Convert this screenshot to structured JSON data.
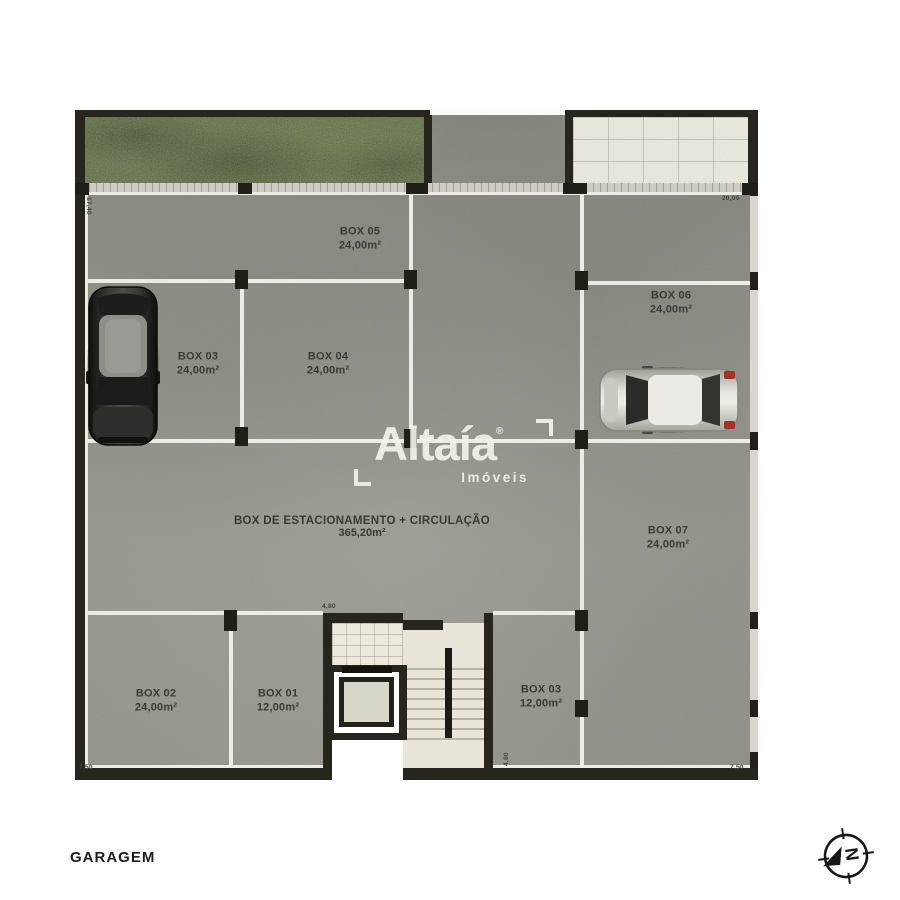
{
  "page": {
    "bottom_label": "GARAGEM"
  },
  "logo": {
    "brand": "Altaía",
    "registered": "®",
    "subtitle": "Imóveis"
  },
  "plan": {
    "central": {
      "line1": "BOX DE ESTACIONAMENTO + CIRCULAÇÃO",
      "line2": "365,20m²"
    },
    "boxes": [
      {
        "label": "BOX 05",
        "area": "24,00m²"
      },
      {
        "label": "BOX 06",
        "area": "24,00m²"
      },
      {
        "label": "BOX 03",
        "area": "24,00m²"
      },
      {
        "label": "BOX 04",
        "area": "24,00m²"
      },
      {
        "label": "BOX 07",
        "area": "24,00m²"
      },
      {
        "label": "BOX 02",
        "area": "24,00m²"
      },
      {
        "label": "BOX 01",
        "area": "12,00m²"
      },
      {
        "label": "BOX 03",
        "area": "12,00m²"
      }
    ],
    "dimensions": {
      "top_right": "20,00",
      "left_side": "17,40",
      "core_top": "4,80",
      "core_side": "4,80",
      "bottom_left": "7,50",
      "bottom_right": "7,50"
    },
    "colors": {
      "wall": "#26261f",
      "floor": "#94938b",
      "grass": "#5a683b",
      "divider_line": "#edece4",
      "tile": "#edeade"
    }
  },
  "compass": {
    "north_letter": "N"
  }
}
